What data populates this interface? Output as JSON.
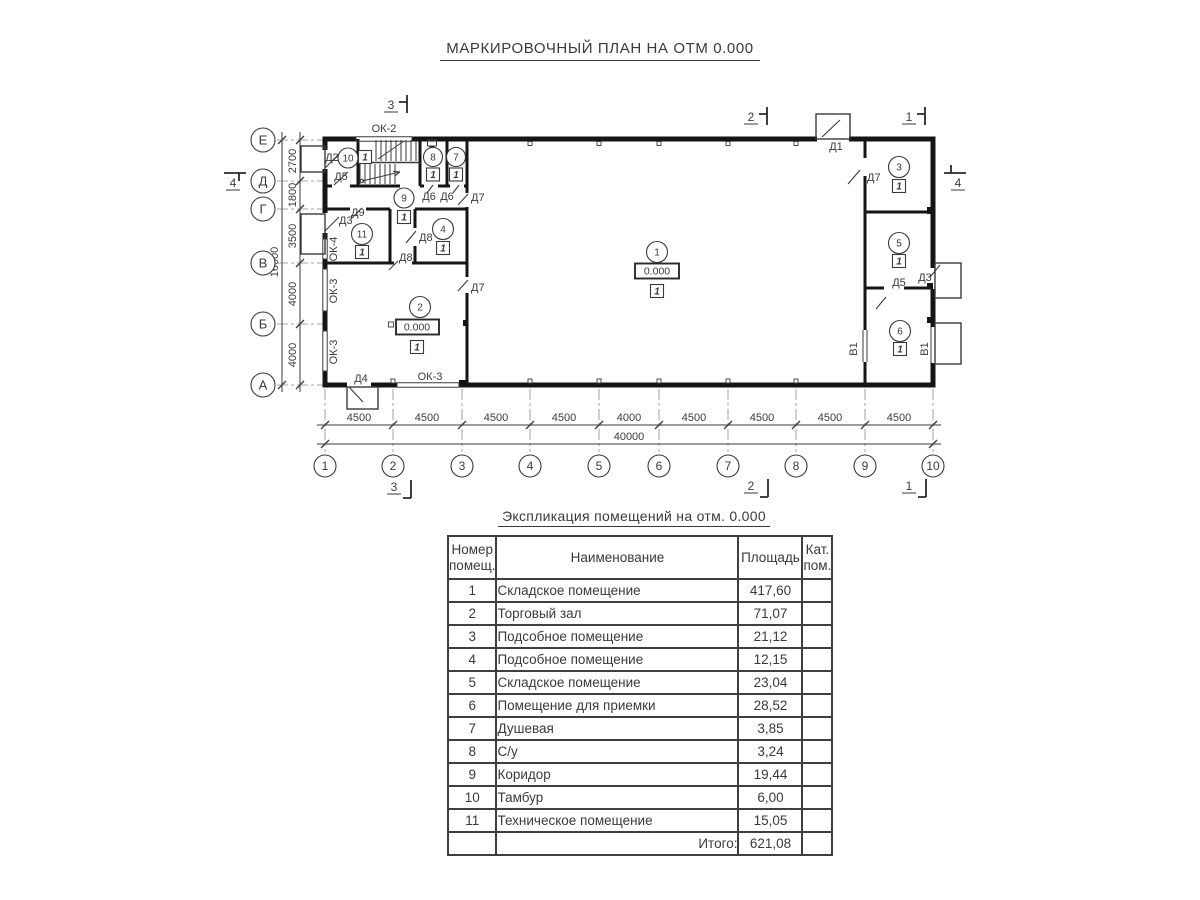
{
  "title": "МАРКИРОВОЧНЫЙ ПЛАН НА ОТМ 0.000",
  "plan": {
    "level_mark": "0.000",
    "type_marker": "1",
    "rooms": [
      "1",
      "2",
      "3",
      "4",
      "5",
      "6",
      "7",
      "8",
      "9",
      "10",
      "11"
    ],
    "doors": {
      "d1": "Д1",
      "d2": "Д2",
      "d3": "Д3",
      "d4": "Д4",
      "d5": "Д5",
      "d6": "Д6",
      "d7": "Д7",
      "d8": "Д8",
      "d9": "Д9"
    },
    "windows": {
      "ok2": "ОК-2",
      "ok3": "ОК-3",
      "ok4": "ОК-4"
    },
    "gate_label": "В1",
    "sections": {
      "s1": "1",
      "s2": "2",
      "s3": "3",
      "s4": "4"
    },
    "cols": [
      "1",
      "2",
      "3",
      "4",
      "5",
      "6",
      "7",
      "8",
      "9",
      "10"
    ],
    "rows": [
      "Е",
      "Д",
      "Г",
      "В",
      "Б",
      "А"
    ],
    "dims_bottom": [
      "4500",
      "4500",
      "4500",
      "4500",
      "4000",
      "4500",
      "4500",
      "4500",
      "4500"
    ],
    "dim_bottom_total": "40000",
    "dims_left": [
      "2700",
      "1800",
      "3500",
      "4000",
      "4000"
    ],
    "dim_left_total": "16000"
  },
  "table": {
    "title": "Экспликация помещений на отм. 0.000",
    "headers": {
      "num1": "Номер",
      "num2": "помещ.",
      "name": "Наименование",
      "area": "Площадь",
      "cat1": "Кат.",
      "cat2": "пом."
    },
    "rows": [
      {
        "num": "1",
        "name": "Складское помещение",
        "area": "417,60"
      },
      {
        "num": "2",
        "name": "Торговый зал",
        "area": "71,07"
      },
      {
        "num": "3",
        "name": "Подсобное помещение",
        "area": "21,12"
      },
      {
        "num": "4",
        "name": "Подсобное помещение",
        "area": "12,15"
      },
      {
        "num": "5",
        "name": "Складское помещение",
        "area": "23,04"
      },
      {
        "num": "6",
        "name": "Помещение для приемки",
        "area": "28,52"
      },
      {
        "num": "7",
        "name": "Душевая",
        "area": "3,85"
      },
      {
        "num": "8",
        "name": "С/у",
        "area": "3,24"
      },
      {
        "num": "9",
        "name": "Коридор",
        "area": "19,44"
      },
      {
        "num": "10",
        "name": "Тамбур",
        "area": "6,00"
      },
      {
        "num": "11",
        "name": "Техническое помещение",
        "area": "15,05"
      }
    ],
    "total_label": "Итого:",
    "total_value": "621,08"
  }
}
